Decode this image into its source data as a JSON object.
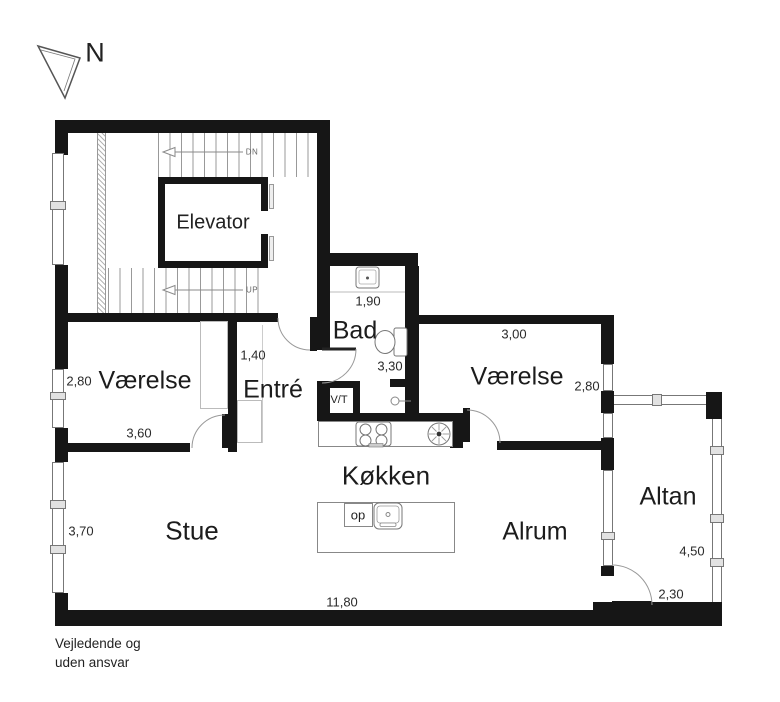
{
  "compass": {
    "label": "N"
  },
  "stairwell": {
    "down_label": "DN",
    "up_label": "UP",
    "elevator_label": "Elevator"
  },
  "rooms": {
    "bad": {
      "label": "Bad",
      "width": "1,90",
      "length": "3,30"
    },
    "entre": {
      "label": "Entré",
      "width": "1,40"
    },
    "vaerelse_west": {
      "label": "Værelse",
      "width": "2,80",
      "length": "3,60"
    },
    "vaerelse_east": {
      "label": "Værelse",
      "width": "3,00",
      "depth": "2,80"
    },
    "koekken": {
      "label": "Køkken",
      "island_label": "op"
    },
    "stue": {
      "label": "Stue",
      "width": "3,70",
      "length": "11,80"
    },
    "alrum": {
      "label": "Alrum"
    },
    "altan": {
      "label": "Altan",
      "length": "4,50",
      "width": "2,30"
    },
    "vt": {
      "label": "V/T"
    }
  },
  "disclaimer": {
    "line1": "Vejledende og",
    "line2": "uden ansvar"
  },
  "colors": {
    "wall": "#161616",
    "thin_line": "#888888",
    "text": "#222222",
    "background": "#ffffff"
  }
}
